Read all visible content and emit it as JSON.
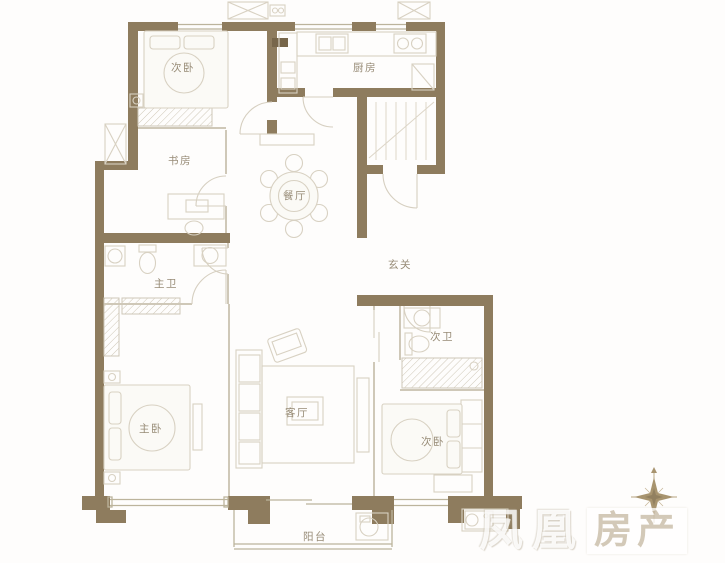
{
  "rooms": {
    "bedroom2_top": {
      "label": "次卧"
    },
    "study": {
      "label": "书房"
    },
    "dining": {
      "label": "餐厅"
    },
    "kitchen": {
      "label": "厨房"
    },
    "entry": {
      "label": "玄关"
    },
    "master_bath": {
      "label": "主卫"
    },
    "master_bedroom": {
      "label": "主卧"
    },
    "living": {
      "label": "客厅"
    },
    "second_bath": {
      "label": "次卫"
    },
    "bedroom2_bottom": {
      "label": "次卧"
    },
    "balcony": {
      "label": "阳台"
    }
  },
  "watermark": {
    "brand": "凤凰",
    "suffix": "房产"
  },
  "colors": {
    "wall": "#8e7c5e",
    "wall_dark": "#77664a",
    "furniture_line": "#d8d1c2",
    "partition_line": "#cfc8b8",
    "window_line": "#bcb49c",
    "label_text": "#978b76",
    "compass": "#a8946f",
    "background": "#fefdfc",
    "watermark_text": "#b3a284"
  }
}
